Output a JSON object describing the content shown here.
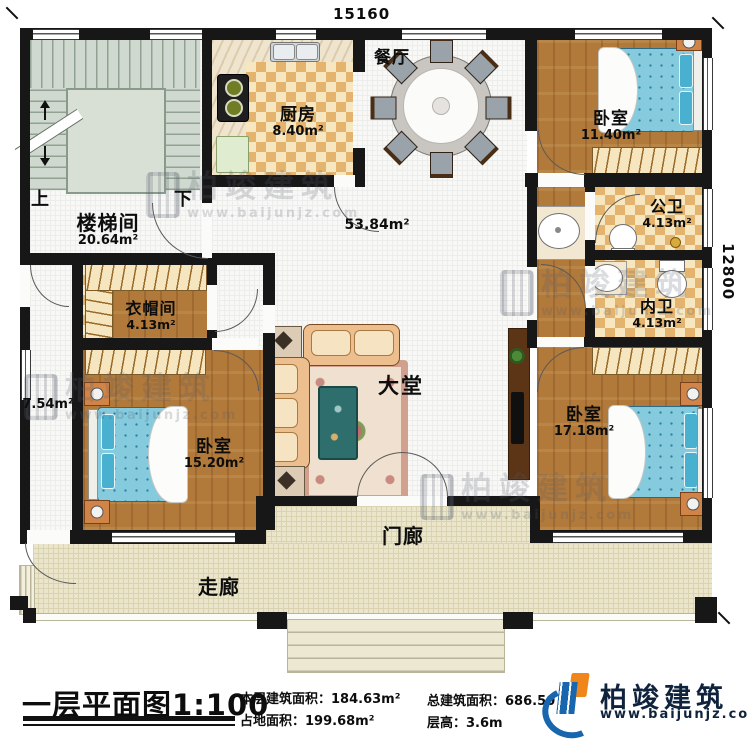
{
  "dimensions": {
    "top": "15160",
    "right": "12800"
  },
  "rooms": {
    "staircase": {
      "name": "楼梯间",
      "area": "20.64m²"
    },
    "stair_up": "上",
    "stair_down": "下",
    "kitchen": {
      "name": "厨房",
      "area": "8.40m²"
    },
    "dining": {
      "name": "餐厅"
    },
    "hall": {
      "name": "大堂",
      "area": "53.84m²"
    },
    "bedroom_top_right": {
      "name": "卧室",
      "area": "11.40m²"
    },
    "public_bath": {
      "name": "公卫",
      "area": "4.13m²"
    },
    "inner_bath": {
      "name": "内卫",
      "area": "4.13m²"
    },
    "cloakroom": {
      "name": "衣帽间",
      "area": "4.13m²"
    },
    "side_hall": {
      "area": "7.54m²"
    },
    "bedroom_left": {
      "name": "卧室",
      "area": "15.20m²"
    },
    "bedroom_bottom_right": {
      "name": "卧室",
      "area": "17.18m²"
    },
    "porch": {
      "name": "门廊"
    },
    "veranda": {
      "name": "走廊"
    }
  },
  "title_block": {
    "title": "一层平面图",
    "scale": "1:100",
    "stats": [
      {
        "label": "本层建筑面积：",
        "value": "184.63m²"
      },
      {
        "label": "占地面积：",
        "value": "199.68m²"
      },
      {
        "label": "总建筑面积：",
        "value": "686.50"
      },
      {
        "label": "层高：",
        "value": "3.6m"
      }
    ]
  },
  "brand": {
    "name": "柏竣建筑",
    "url": "www.baijunjz.com"
  },
  "watermark": {
    "name": "柏竣建筑",
    "url": "www.baijunjz.com"
  },
  "colors": {
    "wall": "#171717",
    "wood": "#b1793a",
    "checker": "#e4b46e",
    "tile": "#f8f8f6",
    "veranda": "#eae5cb",
    "bed": "#86cadd",
    "brand_blue": "#1866ae",
    "brand_orange": "#f08519"
  }
}
